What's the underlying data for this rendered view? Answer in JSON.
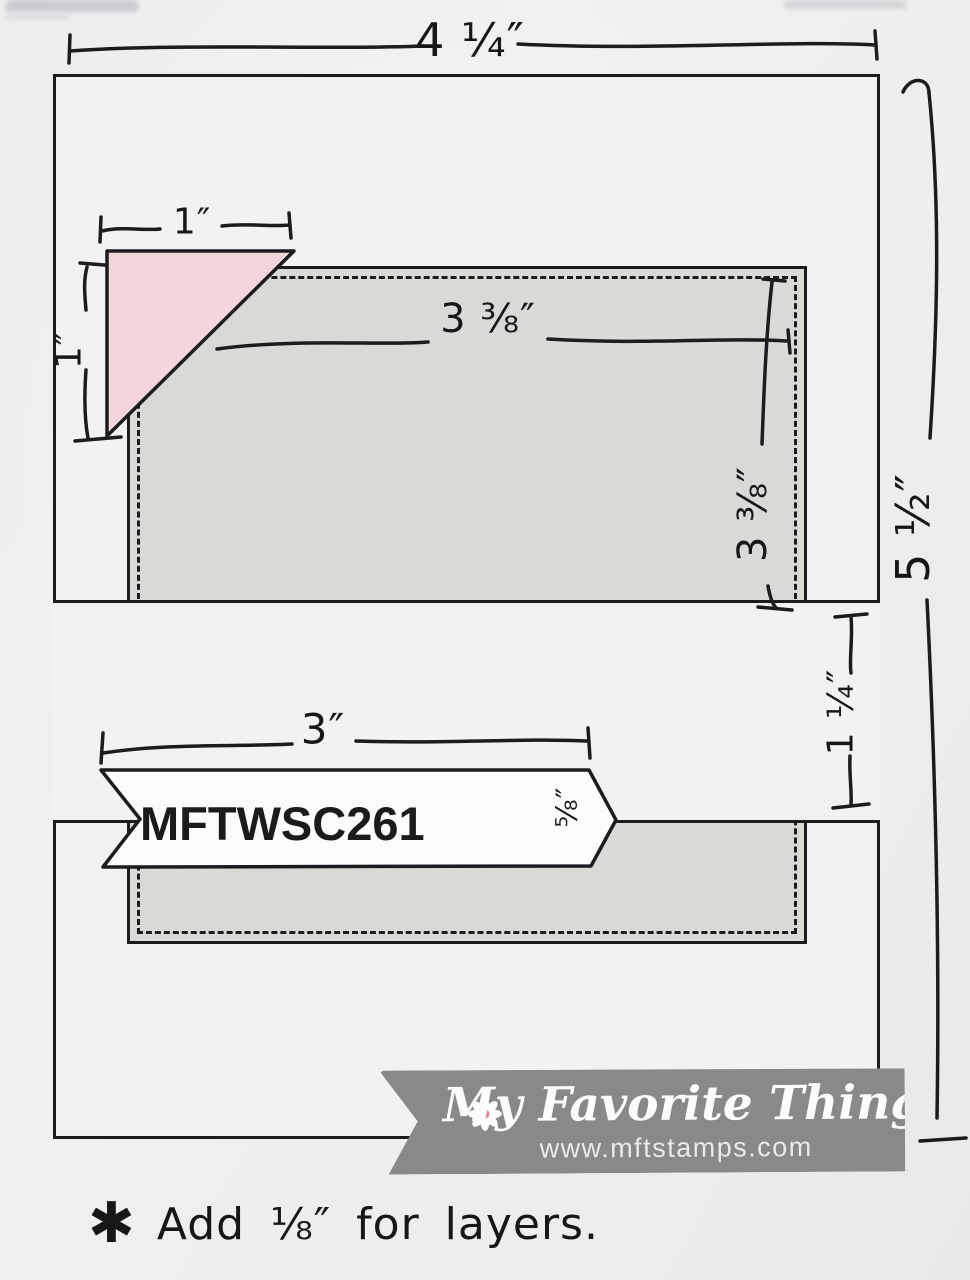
{
  "sketch": {
    "code": "MFTWSC261",
    "dims": {
      "card_width": "4 ¼″",
      "card_height": "5 ½″",
      "corner_width": "1″",
      "corner_height": "1″",
      "panel_width": "3 ⅜″",
      "panel_height": "3 ⅜″",
      "band_height": "1 ¼″",
      "banner_width": "3″",
      "banner_height": "⅝″"
    },
    "colors": {
      "ink": "#1c1c1f",
      "panel_gray": "#d8dad6",
      "corner_pink": "#f4d5da",
      "logo_gray": "#8b8987"
    }
  },
  "logo": {
    "brand": "My Favorite Things",
    "url": "www.mftstamps.com"
  },
  "note": {
    "marker": "✱",
    "text": "Add ⅛″ for layers."
  }
}
